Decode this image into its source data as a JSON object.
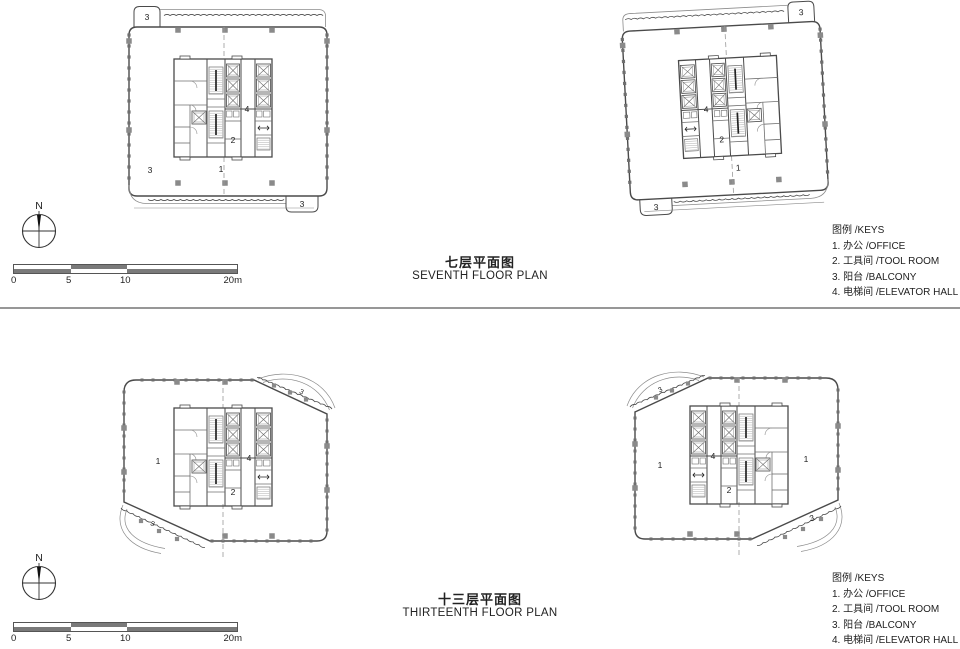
{
  "colors": {
    "line": "#4a4a4a",
    "soft": "#8c8c8c",
    "mid": "#6f6f6f",
    "tick": "#6e6e6e",
    "column": "#8a8a8a",
    "axis": "#9a9a9a",
    "divider": "#979797",
    "text": "#222222",
    "scale_dark": "#7a7a7a"
  },
  "north": {
    "label": "N"
  },
  "scale_bar": {
    "labels": [
      "0",
      "5",
      "10",
      "20m"
    ]
  },
  "sections": [
    {
      "id": "seventh",
      "title_zh": "七层平面图",
      "title_en": "SEVENTH FLOOR PLAN",
      "legend": {
        "title": "图例 /KEYS",
        "items": [
          "1. 办公 /OFFICE",
          "2. 工具间 /TOOL ROOM",
          "3. 阳台 /BALCONY",
          "4. 电梯间 /ELEVATOR HALL"
        ]
      },
      "plans": [
        {
          "id": "plan-seventh-left",
          "room_labels": [
            "3",
            "3",
            "1",
            "4",
            "2",
            "3"
          ]
        },
        {
          "id": "plan-seventh-right",
          "room_labels": [
            "3",
            "4",
            "2",
            "1",
            "3"
          ]
        }
      ]
    },
    {
      "id": "thirteenth",
      "title_zh": "十三层平面图",
      "title_en": "THIRTEENTH FLOOR PLAN",
      "legend": {
        "title": "图例 /KEYS",
        "items": [
          "1. 办公 /OFFICE",
          "2. 工具间 /TOOL ROOM",
          "3. 阳台 /BALCONY",
          "4. 电梯间 /ELEVATOR HALL"
        ]
      },
      "plans": [
        {
          "id": "plan-thirteenth-left",
          "room_labels": [
            "3",
            "1",
            "4",
            "2",
            "3"
          ]
        },
        {
          "id": "plan-thirteenth-right",
          "room_labels": [
            "3",
            "1",
            "4",
            "2",
            "1",
            "3"
          ]
        }
      ]
    }
  ]
}
